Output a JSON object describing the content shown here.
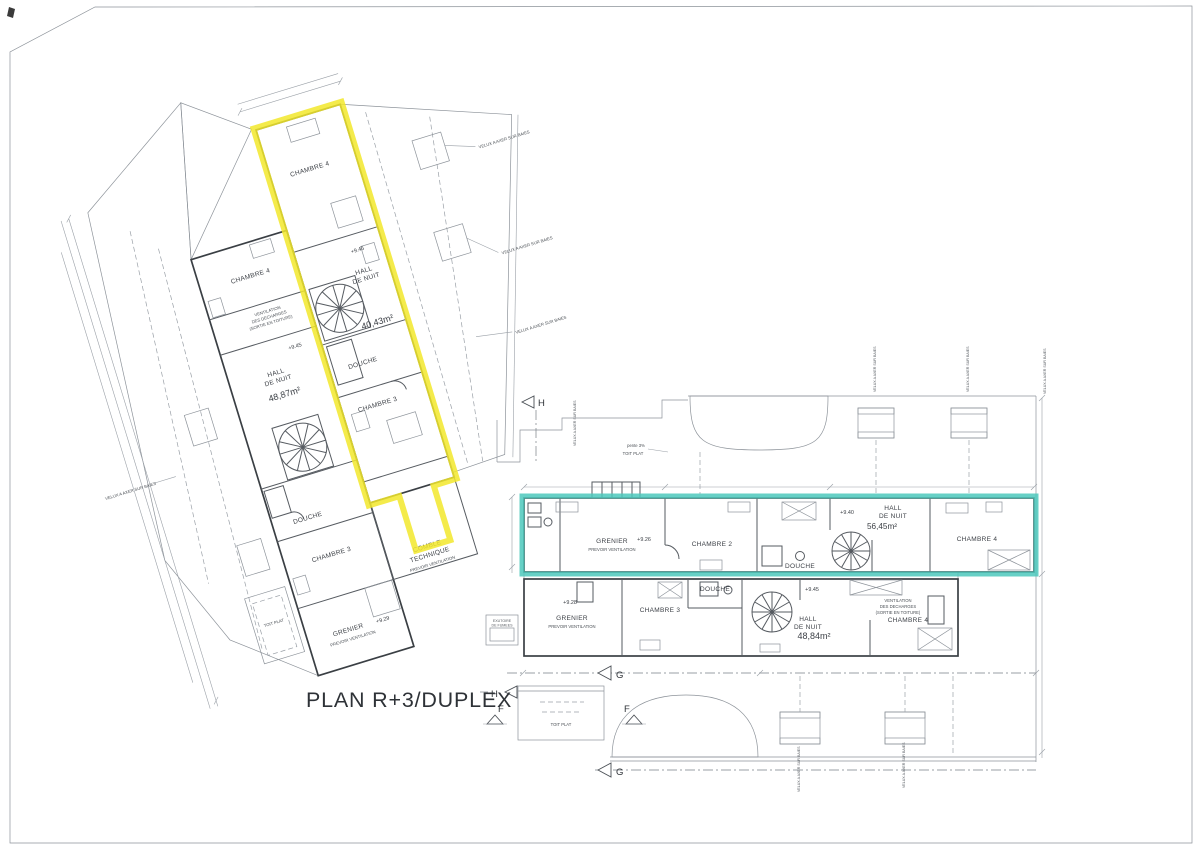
{
  "title": "PLAN R+3/DUPLEX",
  "markers": {
    "h": "H",
    "g": "G",
    "f": "F"
  },
  "colors": {
    "highlight_yellow": "#f2e72b",
    "highlight_teal": "#4cc8bc",
    "ink": "#3d4147"
  },
  "notes": {
    "velux_axer": "VELUX A AXER SUR BAIES",
    "prevoir_ventilation": "PREVOIR VENTILATION",
    "ventilation_1": "VENTILATION",
    "ventilation_2": "DES DECHARGES",
    "ventilation_3": "(SORTIE EN TOITURE)",
    "toit_plat": "TOIT PLAT",
    "pente": "pente 3%",
    "exutoire_1": "EXUTOIRE",
    "exutoire_2": "DE FUMEES"
  },
  "plans": {
    "left": {
      "unit_a": {
        "chambre4": "CHAMBRE 4",
        "level": "+9.45",
        "hall_line1": "HALL",
        "hall_line2": "DE NUIT",
        "hall_area": "48,87m²",
        "douche": "DOUCHE",
        "chambre3": "CHAMBRE 3",
        "grenier": "GRENIER",
        "grenier_level": "+9.29"
      },
      "unit_b": {
        "chambre4": "CHAMBRE 4",
        "level": "+9.45",
        "hall_line1": "HALL",
        "hall_line2": "DE NUIT",
        "hall_area": "40,43m²",
        "douche": "DOUCHE",
        "chambre3": "CHAMBRE 3",
        "comble_line1": "COMBLE",
        "comble_line2": "TECHNIQUE"
      }
    },
    "right": {
      "strip_top": {
        "grenier": "GRENIER",
        "grenier_level": "+9.26",
        "chambre2": "CHAMBRE 2",
        "douche": "DOUCHE",
        "hall_level": "+9.40",
        "hall_line1": "HALL",
        "hall_line2": "DE NUIT",
        "hall_area": "56,45m²",
        "chambre4": "CHAMBRE 4"
      },
      "strip_bottom": {
        "grenier": "GRENIER",
        "grenier_level": "+9.28",
        "chambre3": "CHAMBRE 3",
        "douche": "DOUCHE",
        "hall_level": "+9.45",
        "hall_line1": "HALL",
        "hall_line2": "DE NUIT",
        "hall_area": "48,84m²",
        "chambre4": "CHAMBRE 4"
      }
    }
  }
}
